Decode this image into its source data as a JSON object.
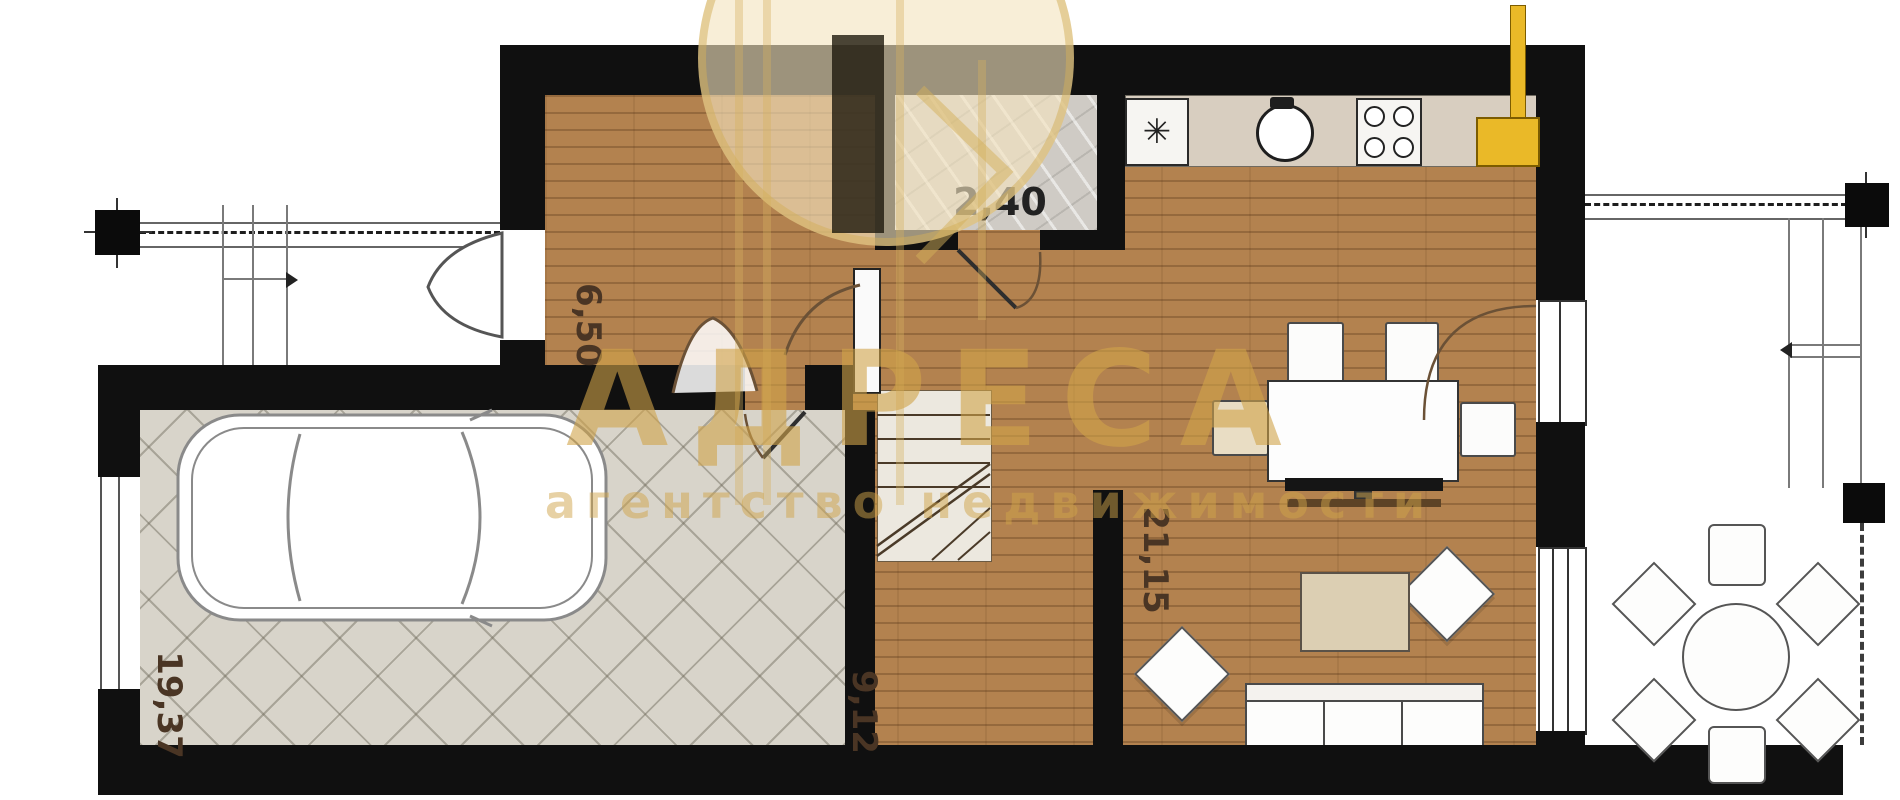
{
  "watermark": {
    "brand": "АДРЕСА",
    "tagline": "агентство недвижимости"
  },
  "rooms": {
    "hallway": {
      "name": "hallway",
      "area": "6,50"
    },
    "bathroom": {
      "name": "bathroom",
      "area": "2,40"
    },
    "living_kitchen": {
      "name": "kitchen-living-room",
      "area": "21,15"
    },
    "corridor": {
      "name": "corridor-stairs",
      "area": "9,12"
    },
    "garage": {
      "name": "garage",
      "area": "19,37"
    }
  },
  "kitchen": {
    "fridge_symbol": "✳"
  },
  "colors": {
    "wall": "#101010",
    "wood_floor": "#b3824f",
    "garage_floor": "#d8d4ca",
    "bath_floor": "#cfcbc5",
    "counter": "#d8cec0",
    "accent_yellow": "#eab928",
    "watermark_gold": "#d2a54e"
  }
}
